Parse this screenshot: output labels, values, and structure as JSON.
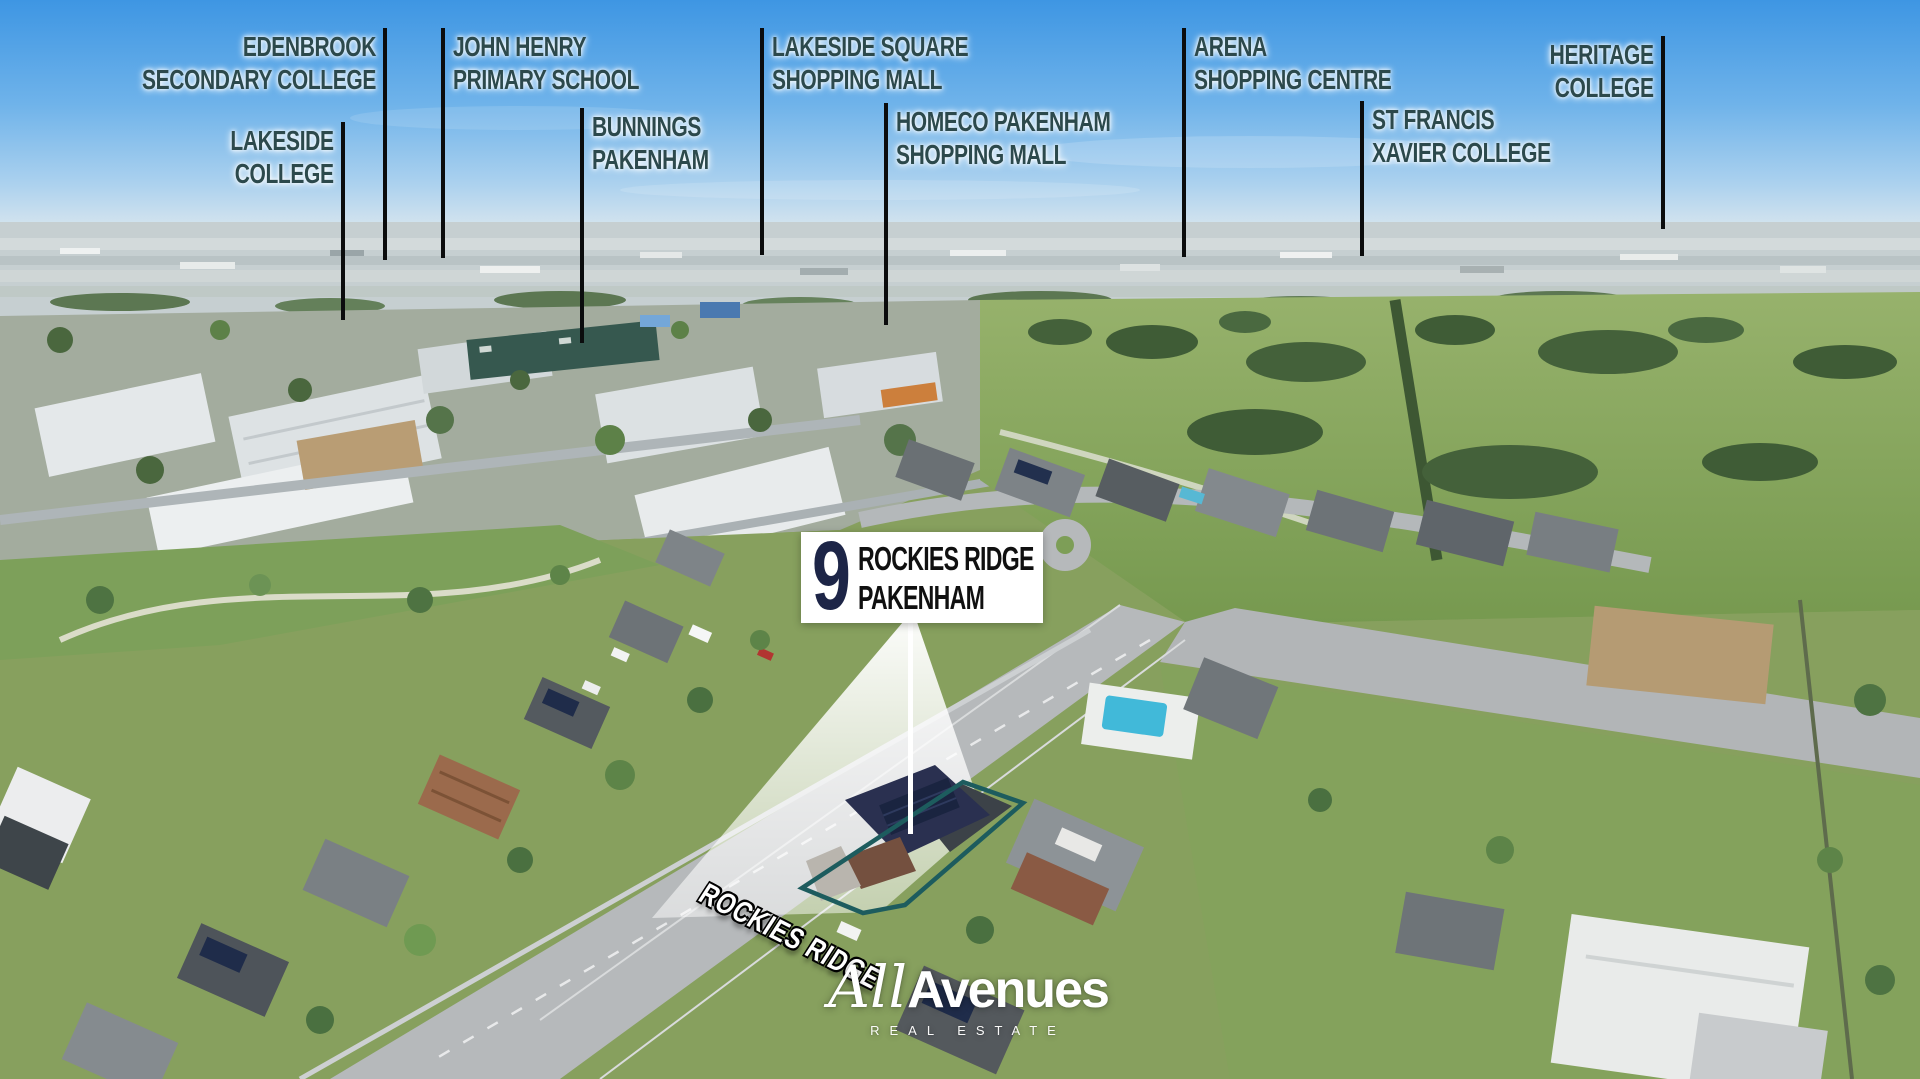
{
  "scene": {
    "kind": "aerial real-estate photograph",
    "suburb_shown": "PAKENHAM"
  },
  "colors": {
    "sky_top": "#3e96e3",
    "sky_horizon": "#d9e6ee",
    "label_text": "#2c494c",
    "pointer_line": "#0b0c0d",
    "callout_bg": "#ffffff",
    "callout_number": "#1d2547",
    "callout_text": "#101010",
    "lot_outline": "#1d5c5e",
    "beam_overlay": "#ffffff",
    "street_text": "#ffffff",
    "logo_text": "#ffffff",
    "bunnings_roof": "#36584f",
    "pool_water": "#41b9d9"
  },
  "landmark_labels": [
    {
      "id": "edenbrook",
      "line1": "EDENBROOK",
      "line2": "SECONDARY COLLEGE",
      "align": "right",
      "text_y": 30,
      "pointer": {
        "x": 385,
        "y1": 28,
        "y2": 260
      }
    },
    {
      "id": "lakeside-college",
      "line1": "LAKESIDE",
      "line2": "COLLEGE",
      "align": "right",
      "text_y": 124,
      "pointer": {
        "x": 343,
        "y1": 122,
        "y2": 320
      }
    },
    {
      "id": "john-henry",
      "line1": "JOHN HENRY",
      "line2": "PRIMARY SCHOOL",
      "align": "left",
      "text_y": 30,
      "pointer": {
        "x": 443,
        "y1": 28,
        "y2": 258
      }
    },
    {
      "id": "bunnings",
      "line1": "BUNNINGS",
      "line2": "PAKENHAM",
      "align": "left",
      "text_y": 110,
      "pointer": {
        "x": 582,
        "y1": 108,
        "y2": 343
      }
    },
    {
      "id": "lakeside-square",
      "line1": "LAKESIDE SQUARE",
      "line2": "SHOPPING MALL",
      "align": "left",
      "text_y": 30,
      "pointer": {
        "x": 762,
        "y1": 28,
        "y2": 255
      }
    },
    {
      "id": "homeco",
      "line1": "HOMECO PAKENHAM",
      "line2": "SHOPPING MALL",
      "align": "left",
      "text_y": 105,
      "pointer": {
        "x": 886,
        "y1": 103,
        "y2": 325
      }
    },
    {
      "id": "arena",
      "line1": "ARENA",
      "line2": "SHOPPING CENTRE",
      "align": "left",
      "text_y": 30,
      "pointer": {
        "x": 1184,
        "y1": 28,
        "y2": 257
      }
    },
    {
      "id": "st-francis",
      "line1": "ST FRANCIS",
      "line2": "XAVIER COLLEGE",
      "align": "left",
      "text_y": 103,
      "pointer": {
        "x": 1362,
        "y1": 101,
        "y2": 256
      }
    },
    {
      "id": "heritage",
      "line1": "HERITAGE",
      "line2": "COLLEGE",
      "align": "right",
      "text_y": 38,
      "pointer": {
        "x": 1663,
        "y1": 36,
        "y2": 229
      }
    }
  ],
  "property_callout": {
    "number": "9",
    "street": "ROCKIES RIDGE",
    "suburb": "PAKENHAM"
  },
  "street_sign": {
    "text": "ROCKIES RIDGE"
  },
  "logo": {
    "name_italic": "All",
    "name_bold": "Avenues",
    "tagline": "REAL ESTATE"
  }
}
